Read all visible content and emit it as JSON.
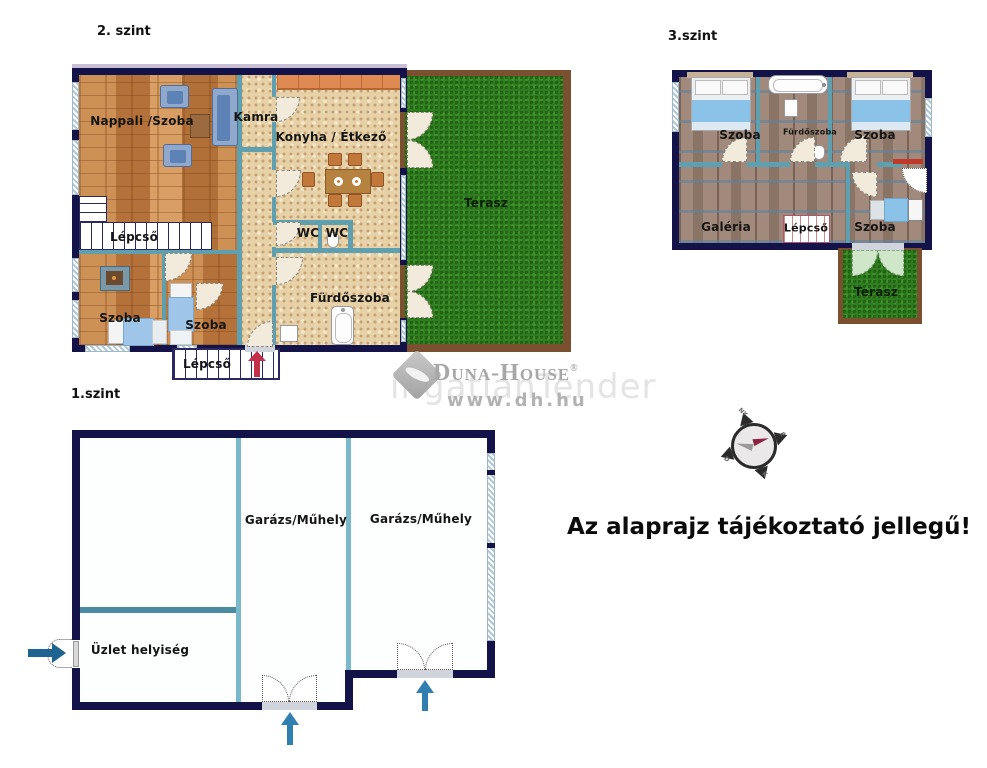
{
  "floor2": {
    "title": "2. szint",
    "rooms": {
      "nappali": "Nappali /Szoba",
      "kamra": "Kamra",
      "konyha": "Konyha / Étkező",
      "terasz": "Terasz",
      "lepcso_felso": "Lépcső",
      "wc_1": "WC",
      "wc_2": "WC",
      "furdoszoba": "Fürdőszoba",
      "szoba_1": "Szoba",
      "szoba_2": "Szoba",
      "lepcso_also": "Lépcső"
    }
  },
  "floor3": {
    "title": "3.szint",
    "rooms": {
      "szoba_bal": "Szoba",
      "furdoszoba": "Fürdőszoba",
      "szoba_jobb": "Szoba",
      "galeria": "Galéria",
      "lepcso": "Lépcső",
      "szoba_also": "Szoba",
      "terasz": "Terasz"
    }
  },
  "floor1": {
    "title": "1.szint",
    "rooms": {
      "garazs_1": "Garázs/Műhely",
      "garazs_2": "Garázs/Műhely",
      "uzlet": "Üzlet helyiség"
    }
  },
  "disclaimer": "Az alaprajz tájékoztató jellegű!",
  "watermark": {
    "brand": "Duna-House",
    "registered": "®",
    "url": "www.dh.hu",
    "ghost": "ingatlanTender"
  },
  "compass": {
    "north": "É",
    "east": "K",
    "south": "D",
    "west": "NY"
  },
  "colors": {
    "outer_wall": "#13134a",
    "inner_wall": "#5e9fb0",
    "wood_floor": "#c58a4f",
    "tile_floor": "#e6d1a8",
    "upper_floor": "#a18a7b",
    "grass": "#2f7d20",
    "terrace_border": "#7a5030",
    "counter": "#de8a52",
    "arrow_red": "#c23049",
    "arrow_blue": "#2f7fb0",
    "bed_blue": "#8ac2e8"
  }
}
